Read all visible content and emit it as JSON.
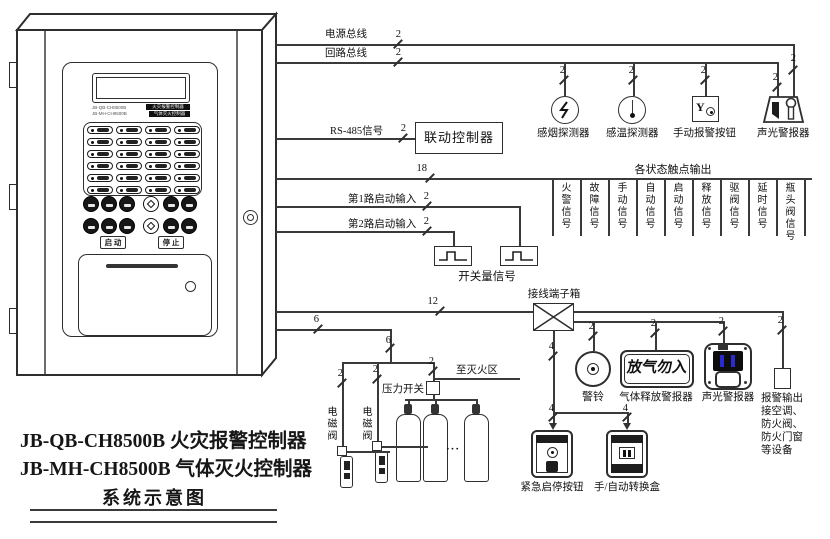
{
  "title": {
    "line1": "JB-QB-CH8500B 火灾报警控制器",
    "line2": "JB-MH-CH8500B 气体灭火控制器",
    "line3": "系统示意图"
  },
  "cabinet": {
    "model1": "JB-QB-CH8500B",
    "model2": "JB-MH-CH8500B",
    "tag1": "火灾报警控制器",
    "tag2": "气体灭火控制器",
    "start_btn": "启 动",
    "stop_btn": "停 止"
  },
  "wires": {
    "power_bus": "电源总线",
    "loop_bus": "回路总线",
    "rs485": "RS-485信号",
    "input1": "第1路启动输入",
    "input2": "第2路启动输入",
    "n2": "2",
    "n4": "4",
    "n6": "6",
    "n12": "12",
    "n18": "18"
  },
  "linkage_controller": "联动控制器",
  "status_header": "各状态触点输出",
  "status_signals": [
    "火警信号",
    "故障信号",
    "手动信号",
    "自动信号",
    "启动信号",
    "释放信号",
    "驱阀信号",
    "延时信号",
    "瓶头阀信号"
  ],
  "switch_signal": "开关量信号",
  "top_devices": {
    "smoke": "感烟探测器",
    "heat": "感温探测器",
    "manual": "手动报警按钮",
    "sound_light": "声光警报器",
    "manual_glyph": "Y"
  },
  "terminal_box": "接线端子箱",
  "suppression": {
    "solenoid1": "电磁阀",
    "solenoid2": "电磁阀",
    "pressure_switch": "压力开关",
    "to_zone": "至灭火区",
    "dots": "···"
  },
  "outputs": {
    "bell": "警铃",
    "gas_release": "气体释放警报器",
    "gas_sign": "放气勿入",
    "sound_light": "声光警报器",
    "alarm_out1": "报警输出",
    "alarm_out2": "接空调、",
    "alarm_out3": "防火阀、",
    "alarm_out4": "防火门窗",
    "alarm_out5": "等设备",
    "emergency": "紧急启停按钮",
    "manual_auto": "手/自动转换盒"
  }
}
